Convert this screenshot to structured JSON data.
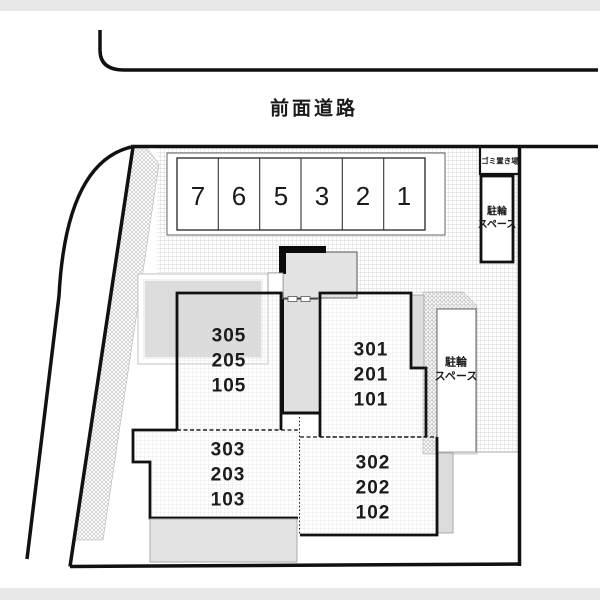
{
  "plan": {
    "title_hint": "site plan",
    "road_label": "前面道路",
    "parking_numbers": [
      "7",
      "6",
      "5",
      "3",
      "2",
      "1"
    ],
    "garbage_label": "ゴミ置き場",
    "bike_north": {
      "line1": "駐輪",
      "line2": "スペース"
    },
    "bike_east": {
      "line1": "駐輪",
      "line2": "スペース"
    },
    "buildings": {
      "west": {
        "units": [
          "305",
          "205",
          "105"
        ]
      },
      "east": {
        "units": [
          "301",
          "201",
          "101"
        ]
      },
      "southwest": {
        "units": [
          "303",
          "203",
          "103"
        ]
      },
      "southeast": {
        "units": [
          "302",
          "202",
          "102"
        ]
      }
    },
    "colors": {
      "line": "#111111",
      "ground_grid": "#c9c9c9",
      "building_grid": "#d8d8d8",
      "hatch": "#bdbdbd",
      "gray_fill": "#e0e0e0",
      "page_bar": "#e8e8e8"
    }
  }
}
